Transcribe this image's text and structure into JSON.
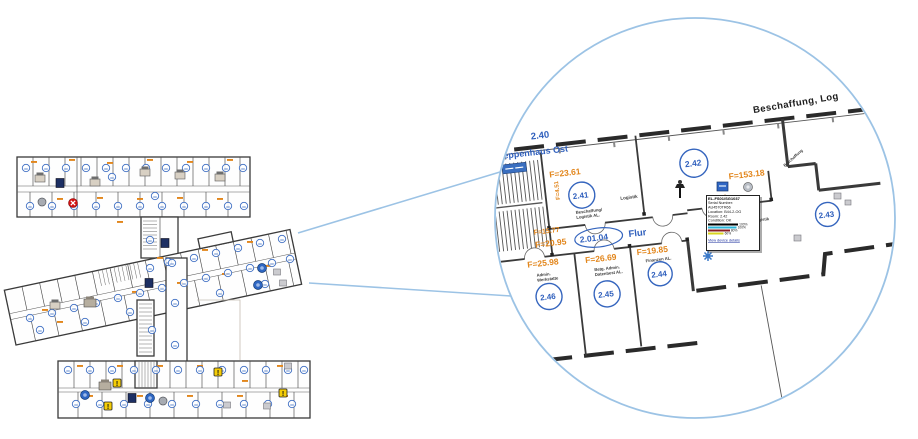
{
  "colors": {
    "lens_blue": "#9cc3e5",
    "badge_blue": "#3f6fc3",
    "label_blue": "#3060bd",
    "area_orange": "#e2861c",
    "alert_yellow": "#f5cd06",
    "error_red": "#d31111",
    "bar_black": "#000000",
    "bar_cyan": "#2ab4d8",
    "bar_maroon": "#8a1f24",
    "bar_yellow": "#d8d41f"
  },
  "magnifier": {
    "building_label": "Beschaffung, Log",
    "labels": {
      "stair_no": "2.40",
      "stair_name": "Treppenhaus Ost",
      "stair_area_vertical": "F=4.51",
      "stair_area_small": "F=15.77",
      "corridor_no": "2.01.04",
      "corridor_name": "Flur",
      "corridor_area": "F=20.95",
      "partial_area_left": "F=3.69",
      "wall_label_1": "Logistik",
      "wall_label_2": "Logistik",
      "wall_label_3": "Beschaffung",
      "conf_label": "conf"
    },
    "rooms": [
      {
        "id": "2.41",
        "area": "F=23.61",
        "dept1": "Beschaffung/",
        "dept2": "Logistik AL."
      },
      {
        "id": "2.42",
        "area": "F=153.18",
        "dept1": "",
        "dept2": ""
      },
      {
        "id": "2.43",
        "area": "",
        "dept1": "",
        "dept2": ""
      },
      {
        "id": "2.44",
        "area": "F=19.85",
        "dept1": "Finanzen AL.",
        "dept2": ""
      },
      {
        "id": "2.45",
        "area": "F=26.69",
        "dept1": "Betg. Admin.",
        "dept2": "Datenbest AL."
      },
      {
        "id": "2.46",
        "area": "F=25.98",
        "dept1": "Admin.",
        "dept2": "Werkstatte"
      }
    ]
  },
  "tooltip": {
    "title": "EL-FS01/SG1037",
    "serial_label": "Serial Number:",
    "serial_value": "AU4570TR66",
    "location": "Location: B44-2-OG",
    "room": "Room: 2.42",
    "condition": "Condition: OK",
    "bars": [
      {
        "color": "#000000",
        "width_pct": 58,
        "label": "100%"
      },
      {
        "color": "#2ab4d8",
        "width_pct": 55,
        "label": "100%"
      },
      {
        "color": "#8a1f24",
        "width_pct": 42,
        "label": "80%"
      },
      {
        "color": "#d8d41f",
        "width_pct": 30,
        "label": "60%"
      }
    ],
    "link": "View device details"
  },
  "overview": {
    "badges": [
      [
        26,
        168
      ],
      [
        46,
        168
      ],
      [
        66,
        168
      ],
      [
        86,
        168
      ],
      [
        106,
        168
      ],
      [
        126,
        168
      ],
      [
        146,
        168
      ],
      [
        166,
        168
      ],
      [
        186,
        168
      ],
      [
        206,
        168
      ],
      [
        226,
        168
      ],
      [
        243,
        168
      ],
      [
        30,
        206
      ],
      [
        52,
        206
      ],
      [
        74,
        206
      ],
      [
        96,
        206
      ],
      [
        118,
        206
      ],
      [
        140,
        206
      ],
      [
        162,
        206
      ],
      [
        184,
        206
      ],
      [
        206,
        206
      ],
      [
        228,
        206
      ],
      [
        244,
        206
      ],
      [
        112,
        177
      ],
      [
        155,
        196
      ],
      [
        150,
        240
      ],
      [
        168,
        262
      ],
      [
        30,
        318
      ],
      [
        52,
        313
      ],
      [
        74,
        308
      ],
      [
        96,
        303
      ],
      [
        118,
        298
      ],
      [
        140,
        293
      ],
      [
        162,
        288
      ],
      [
        184,
        283
      ],
      [
        206,
        278
      ],
      [
        228,
        273
      ],
      [
        250,
        268
      ],
      [
        272,
        263
      ],
      [
        290,
        259
      ],
      [
        150,
        268
      ],
      [
        172,
        263
      ],
      [
        194,
        258
      ],
      [
        216,
        253
      ],
      [
        238,
        248
      ],
      [
        260,
        243
      ],
      [
        282,
        239
      ],
      [
        40,
        330
      ],
      [
        85,
        322
      ],
      [
        130,
        312
      ],
      [
        175,
        303
      ],
      [
        220,
        293
      ],
      [
        265,
        284
      ],
      [
        152,
        330
      ],
      [
        175,
        345
      ],
      [
        68,
        370
      ],
      [
        90,
        370
      ],
      [
        112,
        370
      ],
      [
        134,
        370
      ],
      [
        156,
        370
      ],
      [
        178,
        370
      ],
      [
        200,
        370
      ],
      [
        222,
        370
      ],
      [
        244,
        370
      ],
      [
        266,
        370
      ],
      [
        288,
        370
      ],
      [
        304,
        370
      ],
      [
        76,
        404
      ],
      [
        100,
        404
      ],
      [
        124,
        404
      ],
      [
        148,
        404
      ],
      [
        172,
        404
      ],
      [
        196,
        404
      ],
      [
        220,
        404
      ],
      [
        244,
        404
      ],
      [
        268,
        404
      ],
      [
        292,
        404
      ]
    ],
    "orange_marks": [
      [
        34,
        162
      ],
      [
        72,
        160
      ],
      [
        110,
        163
      ],
      [
        150,
        160
      ],
      [
        190,
        162
      ],
      [
        230,
        160
      ],
      [
        60,
        199
      ],
      [
        100,
        198
      ],
      [
        140,
        199
      ],
      [
        180,
        198
      ],
      [
        220,
        199
      ],
      [
        120,
        222
      ],
      [
        45,
        310
      ],
      [
        90,
        300
      ],
      [
        135,
        292
      ],
      [
        180,
        283
      ],
      [
        225,
        274
      ],
      [
        268,
        266
      ],
      [
        160,
        258
      ],
      [
        205,
        250
      ],
      [
        250,
        242
      ],
      [
        60,
        322
      ],
      [
        80,
        366
      ],
      [
        120,
        366
      ],
      [
        160,
        366
      ],
      [
        200,
        366
      ],
      [
        245,
        381
      ],
      [
        280,
        366
      ],
      [
        90,
        396
      ],
      [
        140,
        396
      ],
      [
        190,
        396
      ],
      [
        240,
        396
      ],
      [
        285,
        396
      ]
    ],
    "devices": [
      {
        "t": "printer",
        "x": 40,
        "y": 178
      },
      {
        "t": "navy",
        "x": 60,
        "y": 183
      },
      {
        "t": "printer",
        "x": 95,
        "y": 182
      },
      {
        "t": "printer",
        "x": 145,
        "y": 172
      },
      {
        "t": "printer",
        "x": 180,
        "y": 175
      },
      {
        "t": "printer",
        "x": 220,
        "y": 177
      },
      {
        "t": "grayround",
        "x": 42,
        "y": 202
      },
      {
        "t": "redx",
        "x": 73,
        "y": 203
      },
      {
        "t": "navy",
        "x": 165,
        "y": 243
      },
      {
        "t": "navy",
        "x": 149,
        "y": 283
      },
      {
        "t": "printer",
        "x": 55,
        "y": 305
      },
      {
        "t": "copier",
        "x": 90,
        "y": 303
      },
      {
        "t": "blueround",
        "x": 262,
        "y": 268
      },
      {
        "t": "blueround",
        "x": 258,
        "y": 285
      },
      {
        "t": "graybox",
        "x": 277,
        "y": 272
      },
      {
        "t": "graybox",
        "x": 283,
        "y": 283
      },
      {
        "t": "blueround",
        "x": 85,
        "y": 395
      },
      {
        "t": "copier",
        "x": 105,
        "y": 386
      },
      {
        "t": "navy",
        "x": 132,
        "y": 398
      },
      {
        "t": "blueround",
        "x": 150,
        "y": 398
      },
      {
        "t": "grayround",
        "x": 163,
        "y": 401
      },
      {
        "t": "graybox",
        "x": 227,
        "y": 405
      },
      {
        "t": "graybox",
        "x": 267,
        "y": 406
      },
      {
        "t": "graybox",
        "x": 288,
        "y": 366
      },
      {
        "t": "alert",
        "x": 117,
        "y": 383
      },
      {
        "t": "alert",
        "x": 218,
        "y": 372
      },
      {
        "t": "alert",
        "x": 108,
        "y": 406
      },
      {
        "t": "alert",
        "x": 283,
        "y": 393
      }
    ]
  }
}
